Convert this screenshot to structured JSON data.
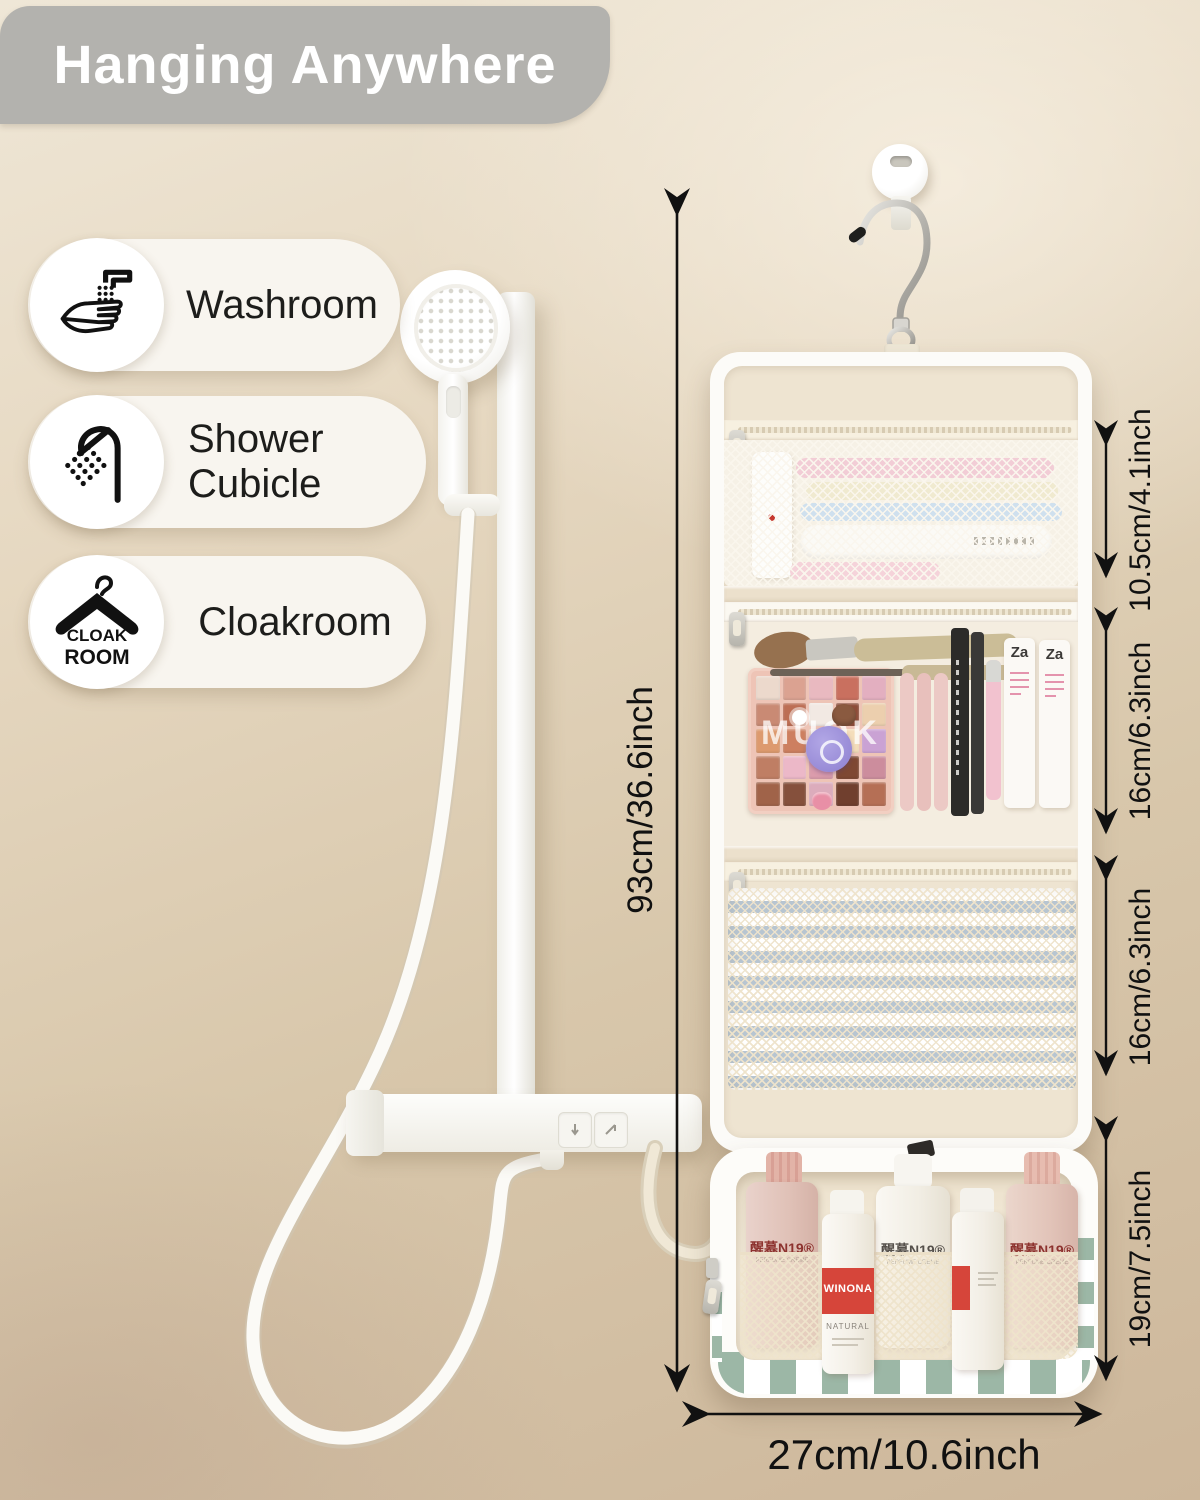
{
  "banner": {
    "title": "Hanging Anywhere",
    "bg": "#b3b2ae",
    "text_color": "#ffffff"
  },
  "locations": [
    {
      "label": "Washroom",
      "icon": "handwash-icon"
    },
    {
      "label": "Shower Cubicle",
      "icon": "shower-icon"
    },
    {
      "label": "Cloakroom",
      "icon": "hanger-icon",
      "icon_text_line1": "CLOAK",
      "icon_text_line2": "ROOM"
    }
  ],
  "dimensions": {
    "total_height": "93cm/36.6inch",
    "pocket1": "10.5cm/4.1inch",
    "pocket2": "16cm/6.3inch",
    "pocket3": "16cm/6.3inch",
    "bag_height": "19cm/7.5inch",
    "bag_width": "27cm/10.6inch"
  },
  "products": {
    "bottle_label": "醒慕N19®",
    "bottle_sublabel": "PERFUME CREME",
    "pump_label": "WINONA",
    "pump_sublabel": "NATURAL",
    "tube_logo": "Za",
    "palette_print": "MUOK"
  },
  "palette": {
    "colors": [
      "#ecd9cc",
      "#dba291",
      "#e9b9c0",
      "#c9705f",
      "#e3afc0",
      "#c98a74",
      "#bd6e54",
      "#f2e9e3",
      "#8d4c38",
      "#eccfae",
      "#dd9a6e",
      "#cd7f60",
      "#e8d3c2",
      "#f4ddba",
      "#caa2d4",
      "#bf7e64",
      "#ecb8c8",
      "#db9cac",
      "#7e4833",
      "#cc8d9d",
      "#a06349",
      "#85503c",
      "#dcacbc",
      "#703f2e",
      "#b56f55"
    ]
  },
  "colors": {
    "wall": "#d9c9af",
    "banner_gray": "#b3b2ae",
    "fabric_cream": "#eee4d1",
    "checker_green": "#9cb7a6",
    "label_red": "#d6453a",
    "bottle_pink": "#e3c3b8",
    "arrow_black": "#111111"
  }
}
